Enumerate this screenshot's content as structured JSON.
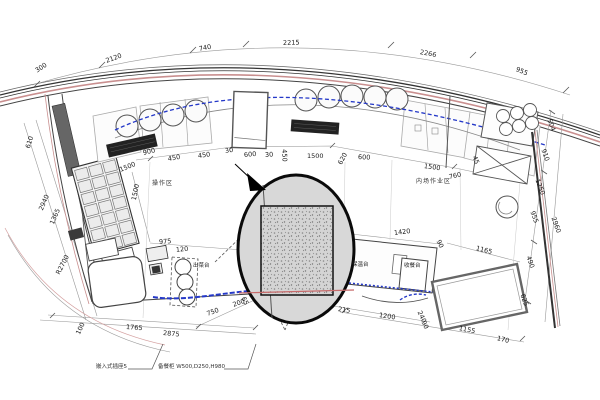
{
  "drawing": {
    "type": "architectural-floor-plan-kitchen",
    "region_labels": {
      "left_zone": "操作区",
      "right_zone": "内场作业区"
    },
    "equipment_labels": {
      "serving_counter": "出菜台",
      "warming_counter": "保温台",
      "collection_counter": "收餐台"
    },
    "notes": {
      "note1": "嵌入式插座5",
      "note2": "备餐柜 W500,D250,H980"
    },
    "dims": {
      "top": [
        "300",
        "2120",
        "740",
        "2215",
        "2266",
        "955"
      ],
      "left": [
        "610",
        "2940",
        "1365",
        "R2700",
        "1500"
      ],
      "middle": [
        "900",
        "1500",
        "450",
        "450",
        "30",
        "600",
        "30",
        "450",
        "1500",
        "620",
        "600",
        "1500",
        "760",
        "45"
      ],
      "center": [
        "975",
        "120",
        "1420",
        "90",
        "1165"
      ],
      "right": [
        "504",
        "910",
        "1250",
        "955",
        "2960",
        "490",
        "625"
      ],
      "bottom": [
        "1765",
        "2875",
        "750",
        "200",
        "65",
        "215",
        "1200",
        "240",
        "90",
        "1155",
        "170",
        "100"
      ]
    },
    "colors": {
      "wall": "#333333",
      "accent_pink": "#c98f8f",
      "pipe_blue": "#2438c8",
      "callout_fill": "#d8d8d8"
    }
  }
}
